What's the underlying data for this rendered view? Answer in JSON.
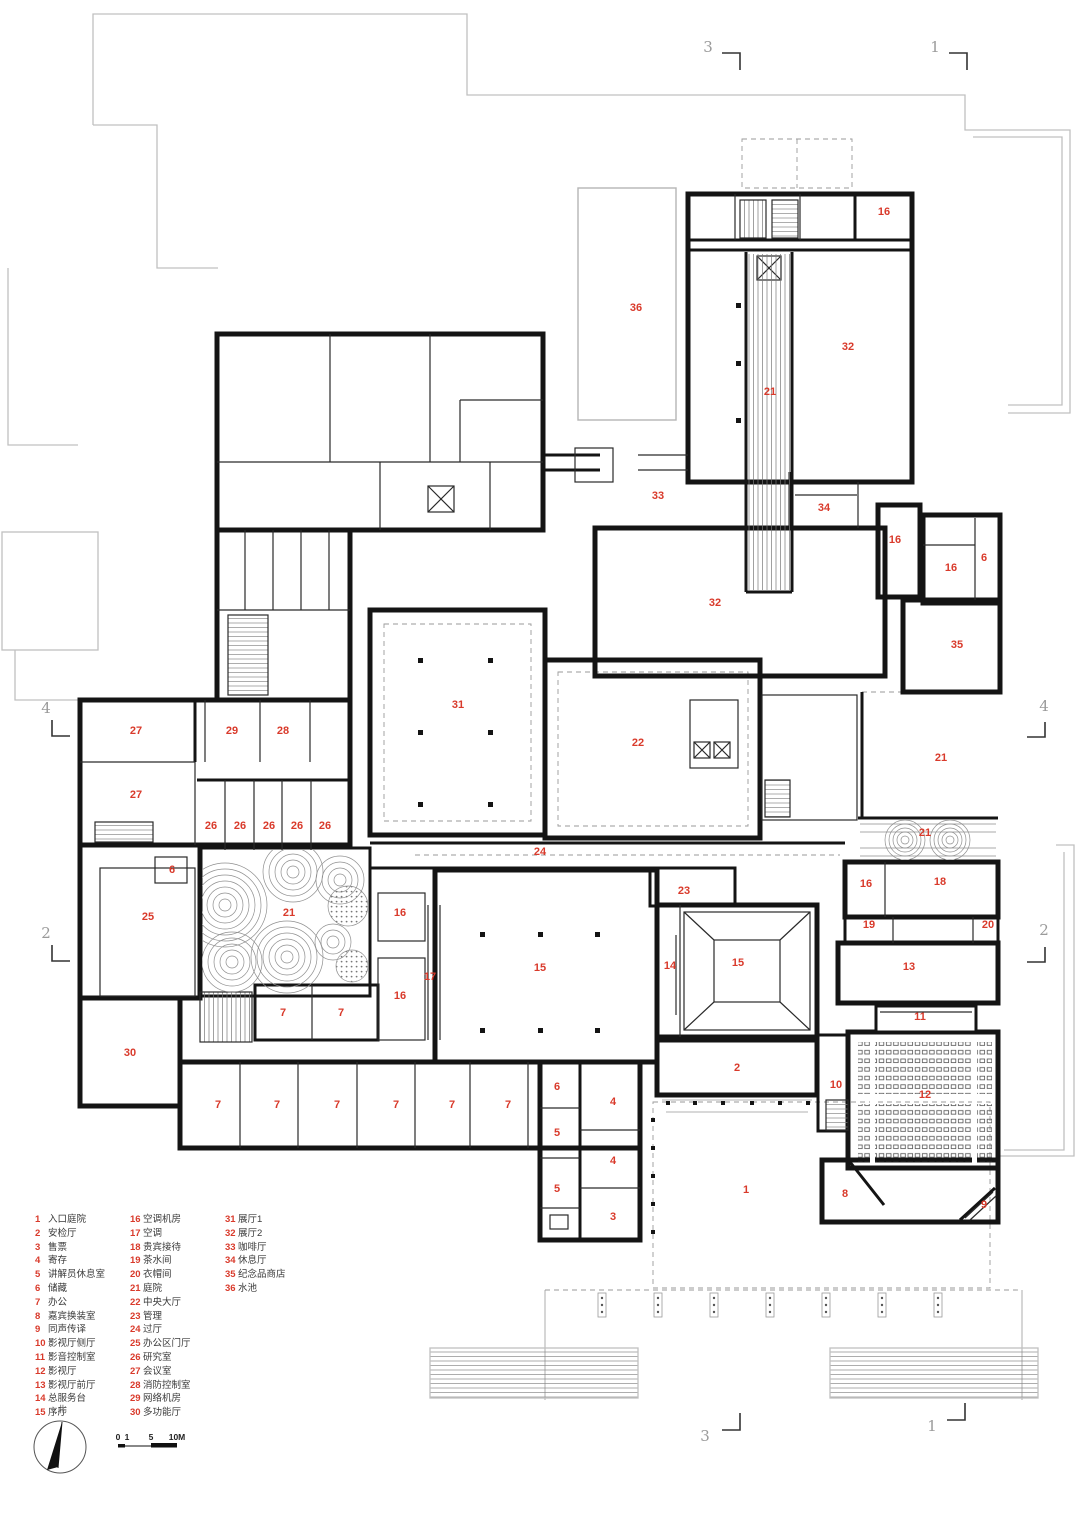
{
  "plan": {
    "room_labels": [
      {
        "n": "36",
        "x": 636,
        "y": 308
      },
      {
        "n": "16",
        "x": 884,
        "y": 212
      },
      {
        "n": "32",
        "x": 848,
        "y": 347
      },
      {
        "n": "21",
        "x": 770,
        "y": 392
      },
      {
        "n": "33",
        "x": 658,
        "y": 496
      },
      {
        "n": "34",
        "x": 824,
        "y": 508
      },
      {
        "n": "16",
        "x": 895,
        "y": 540
      },
      {
        "n": "16",
        "x": 951,
        "y": 568
      },
      {
        "n": "6",
        "x": 984,
        "y": 558
      },
      {
        "n": "32",
        "x": 715,
        "y": 603
      },
      {
        "n": "35",
        "x": 957,
        "y": 645
      },
      {
        "n": "31",
        "x": 458,
        "y": 705
      },
      {
        "n": "22",
        "x": 638,
        "y": 743
      },
      {
        "n": "21",
        "x": 941,
        "y": 758
      },
      {
        "n": "27",
        "x": 136,
        "y": 731
      },
      {
        "n": "29",
        "x": 232,
        "y": 731
      },
      {
        "n": "28",
        "x": 283,
        "y": 731
      },
      {
        "n": "27",
        "x": 136,
        "y": 795
      },
      {
        "n": "26",
        "x": 211,
        "y": 826
      },
      {
        "n": "26",
        "x": 240,
        "y": 826
      },
      {
        "n": "26",
        "x": 269,
        "y": 826
      },
      {
        "n": "26",
        "x": 297,
        "y": 826
      },
      {
        "n": "26",
        "x": 325,
        "y": 826
      },
      {
        "n": "24",
        "x": 540,
        "y": 852
      },
      {
        "n": "21",
        "x": 925,
        "y": 833
      },
      {
        "n": "6",
        "x": 172,
        "y": 870
      },
      {
        "n": "16",
        "x": 866,
        "y": 884
      },
      {
        "n": "18",
        "x": 940,
        "y": 882
      },
      {
        "n": "23",
        "x": 684,
        "y": 891
      },
      {
        "n": "25",
        "x": 148,
        "y": 917
      },
      {
        "n": "21",
        "x": 289,
        "y": 913
      },
      {
        "n": "16",
        "x": 400,
        "y": 913
      },
      {
        "n": "19",
        "x": 869,
        "y": 925
      },
      {
        "n": "20",
        "x": 988,
        "y": 925
      },
      {
        "n": "17",
        "x": 430,
        "y": 977
      },
      {
        "n": "15",
        "x": 540,
        "y": 968
      },
      {
        "n": "14",
        "x": 670,
        "y": 966
      },
      {
        "n": "15",
        "x": 738,
        "y": 963
      },
      {
        "n": "13",
        "x": 909,
        "y": 967
      },
      {
        "n": "16",
        "x": 400,
        "y": 996
      },
      {
        "n": "7",
        "x": 283,
        "y": 1013
      },
      {
        "n": "7",
        "x": 341,
        "y": 1013
      },
      {
        "n": "11",
        "x": 920,
        "y": 1017
      },
      {
        "n": "30",
        "x": 130,
        "y": 1053
      },
      {
        "n": "2",
        "x": 737,
        "y": 1068
      },
      {
        "n": "10",
        "x": 836,
        "y": 1085
      },
      {
        "n": "6",
        "x": 557,
        "y": 1087
      },
      {
        "n": "12",
        "x": 925,
        "y": 1095
      },
      {
        "n": "4",
        "x": 613,
        "y": 1102
      },
      {
        "n": "7",
        "x": 218,
        "y": 1105
      },
      {
        "n": "7",
        "x": 277,
        "y": 1105
      },
      {
        "n": "7",
        "x": 337,
        "y": 1105
      },
      {
        "n": "7",
        "x": 396,
        "y": 1105
      },
      {
        "n": "7",
        "x": 452,
        "y": 1105
      },
      {
        "n": "7",
        "x": 508,
        "y": 1105
      },
      {
        "n": "5",
        "x": 557,
        "y": 1133
      },
      {
        "n": "4",
        "x": 613,
        "y": 1161
      },
      {
        "n": "5",
        "x": 557,
        "y": 1189
      },
      {
        "n": "1",
        "x": 746,
        "y": 1190
      },
      {
        "n": "8",
        "x": 845,
        "y": 1194
      },
      {
        "n": "9",
        "x": 984,
        "y": 1205
      },
      {
        "n": "3",
        "x": 613,
        "y": 1217
      }
    ],
    "grid_markers": [
      {
        "n": "3",
        "x": 708,
        "y": 47
      },
      {
        "n": "1",
        "x": 935,
        "y": 47
      },
      {
        "n": "4",
        "x": 46,
        "y": 708
      },
      {
        "n": "4",
        "x": 1044,
        "y": 706
      },
      {
        "n": "2",
        "x": 46,
        "y": 933
      },
      {
        "n": "2",
        "x": 1044,
        "y": 930
      },
      {
        "n": "3",
        "x": 705,
        "y": 1436
      },
      {
        "n": "1",
        "x": 932,
        "y": 1426
      }
    ]
  },
  "legend": {
    "columns": [
      [
        {
          "num": "1",
          "label": "入口庭院"
        },
        {
          "num": "2",
          "label": "安检厅"
        },
        {
          "num": "3",
          "label": "售票"
        },
        {
          "num": "4",
          "label": "寄存"
        },
        {
          "num": "5",
          "label": "讲解员休息室"
        },
        {
          "num": "6",
          "label": "储藏"
        },
        {
          "num": "7",
          "label": "办公"
        },
        {
          "num": "8",
          "label": "嘉宾换装室"
        },
        {
          "num": "9",
          "label": "同声传译"
        },
        {
          "num": "10",
          "label": "影视厅侧厅"
        },
        {
          "num": "11",
          "label": "影音控制室"
        },
        {
          "num": "12",
          "label": "影视厅"
        },
        {
          "num": "13",
          "label": "影视厅前厅"
        },
        {
          "num": "14",
          "label": "总服务台"
        },
        {
          "num": "15",
          "label": "序厅"
        }
      ],
      [
        {
          "num": "16",
          "label": "空调机房"
        },
        {
          "num": "17",
          "label": "空调"
        },
        {
          "num": "18",
          "label": "贵宾接待"
        },
        {
          "num": "19",
          "label": "茶水间"
        },
        {
          "num": "20",
          "label": "衣帽间"
        },
        {
          "num": "21",
          "label": "庭院"
        },
        {
          "num": "22",
          "label": "中央大厅"
        },
        {
          "num": "23",
          "label": "管理"
        },
        {
          "num": "24",
          "label": "过厅"
        },
        {
          "num": "25",
          "label": "办公区门厅"
        },
        {
          "num": "26",
          "label": "研究室"
        },
        {
          "num": "27",
          "label": "会议室"
        },
        {
          "num": "28",
          "label": "消防控制室"
        },
        {
          "num": "29",
          "label": "网络机房"
        },
        {
          "num": "30",
          "label": "多功能厅"
        }
      ],
      [
        {
          "num": "31",
          "label": "展厅1"
        },
        {
          "num": "32",
          "label": "展厅2"
        },
        {
          "num": "33",
          "label": "咖啡厅"
        },
        {
          "num": "34",
          "label": "休息厅"
        },
        {
          "num": "35",
          "label": "纪念品商店"
        },
        {
          "num": "36",
          "label": "水池"
        }
      ]
    ]
  },
  "compass": {
    "label": "北"
  },
  "scale_bar": {
    "ticks": [
      "0",
      "1",
      "5",
      "10M"
    ]
  },
  "colors": {
    "accent": "#d93a2b",
    "wall": "#141414",
    "site": "#c0c0c0"
  }
}
